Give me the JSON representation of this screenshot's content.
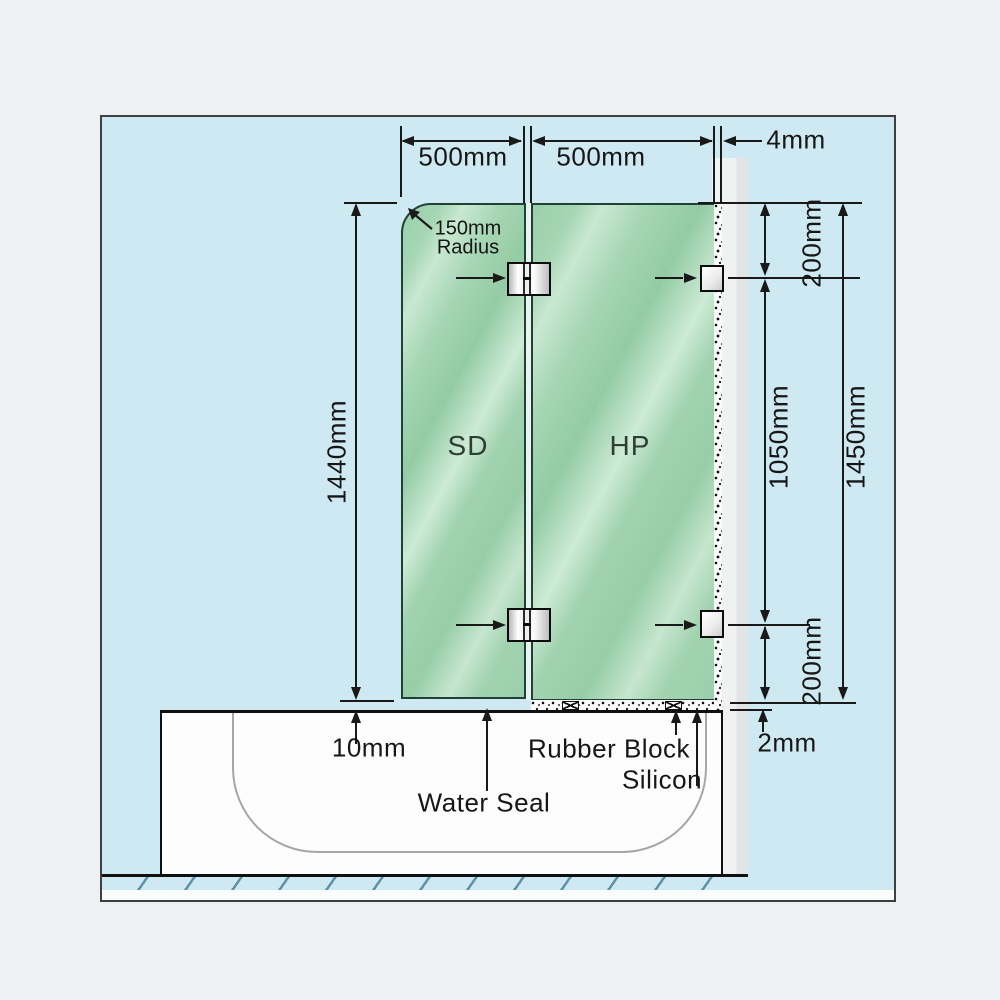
{
  "diagram": {
    "type": "shower-screen-installation-diagram",
    "top_dimensions": {
      "sd_panel_width": "500mm",
      "hp_panel_width": "500mm",
      "wall_gap": "4mm"
    },
    "corner_radius": {
      "line1": "150mm",
      "line2": "Radius"
    },
    "left_dimension": {
      "sd_panel_height": "1440mm"
    },
    "right_dimensions": {
      "top_bracket_offset": "200mm",
      "bracket_spacing": "1050mm",
      "hp_panel_height": "1450mm",
      "bottom_bracket_offset": "200mm",
      "base_silicon_gap": "2mm"
    },
    "panels": {
      "sd_label": "SD",
      "hp_label": "HP"
    },
    "bottom_annotations": {
      "door_gap": "10mm",
      "water_seal": "Water Seal",
      "rubber_block": "Rubber Block",
      "silicon": "Silicon"
    },
    "colors": {
      "page_background": "#eef1f2",
      "diagram_background": "#cfe9f2",
      "glass_green": "#a2d3b1",
      "glass_border": "#204136",
      "wall_gray": "#e8ebeb",
      "tub_white": "#fdfdfd",
      "line_dark": "#191919",
      "hatch_blue": "#5d93a9"
    }
  }
}
